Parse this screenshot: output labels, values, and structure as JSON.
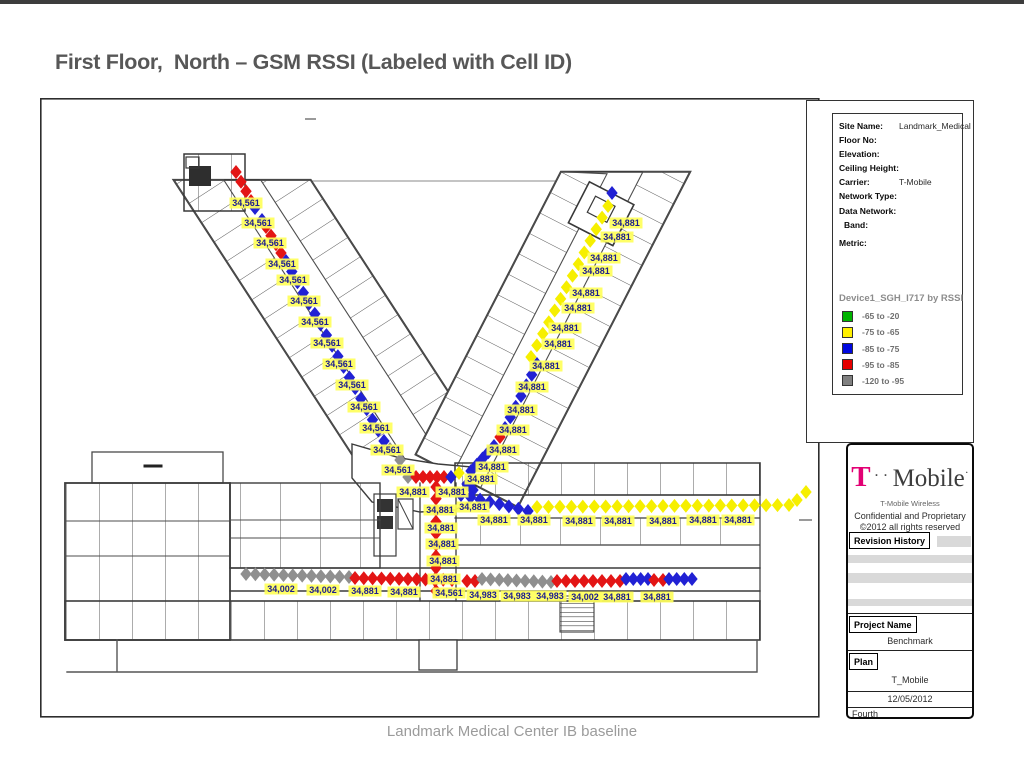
{
  "slide": {
    "title": "First Floor,  North – GSM RSSI (Labeled with Cell ID)",
    "footer": "Landmark Medical Center IB baseline"
  },
  "site_info": {
    "fields": [
      {
        "label": "Site Name:",
        "value": "Landmark_Medical",
        "indent": false,
        "gap": false
      },
      {
        "label": "Floor No:",
        "value": "",
        "indent": false,
        "gap": false
      },
      {
        "label": "Elevation:",
        "value": "",
        "indent": false,
        "gap": false
      },
      {
        "label": "Ceiling Height:",
        "value": "",
        "indent": false,
        "gap": false
      },
      {
        "label": "Carrier:",
        "value": "T-Mobile",
        "indent": false,
        "gap": false
      },
      {
        "label": "Network Type:",
        "value": "",
        "indent": false,
        "gap": false
      },
      {
        "label": "Data Network:",
        "value": "",
        "indent": false,
        "gap": false
      },
      {
        "label": "Band:",
        "value": "",
        "indent": true,
        "gap": false
      },
      {
        "label": "Metric:",
        "value": "",
        "indent": false,
        "gap": true
      }
    ]
  },
  "legend": {
    "title": "Device1_SGH_I717 by RSSI",
    "items": [
      {
        "color": "#00b400",
        "range": "-65 to -20"
      },
      {
        "color": "#fff000",
        "range": "-75 to -65"
      },
      {
        "color": "#0008e0",
        "range": "-85 to -75"
      },
      {
        "color": "#e60000",
        "range": "-95 to -85"
      },
      {
        "color": "#808080",
        "range": "-120 to -95"
      }
    ]
  },
  "titleblock": {
    "logo_t": "T",
    "logo_dots": " · · ",
    "logo_rest": "Mobile",
    "logo_end": "·",
    "company": "T-Mobile Wireless",
    "confidential": "Confidential and Proprietary",
    "copyright": "©2012 all rights reserved",
    "revision_label": "Revision History",
    "project_label": "Project Name",
    "project_value": "Benchmark",
    "plan_label": "Plan",
    "plan_value": "T_Mobile",
    "date": "12/05/2012",
    "floor": "Fourth"
  },
  "plan": {
    "marker_colors": {
      "red": "#e31515",
      "blue": "#2121d4",
      "yellow": "#f6ef00",
      "gray": "#8f8f8f"
    },
    "chains": [
      {
        "c": "red",
        "f": [
          236,
          172
        ],
        "t": [
          251,
          201
        ],
        "n": 4
      },
      {
        "c": "blue",
        "f": [
          255,
          208
        ],
        "t": [
          262,
          220
        ],
        "n": 2
      },
      {
        "c": "red",
        "f": [
          266,
          227
        ],
        "t": [
          281,
          253
        ],
        "n": 4
      },
      {
        "c": "blue",
        "f": [
          286,
          261
        ],
        "t": [
          384,
          441
        ],
        "n": 18
      },
      {
        "c": "gray",
        "f": [
          390,
          449
        ],
        "t": [
          400,
          460
        ],
        "n": 2
      },
      {
        "c": "gray",
        "f": [
          408,
          477
        ],
        "t": [
          408,
          477
        ],
        "n": 1
      },
      {
        "c": "red",
        "f": [
          416,
          477
        ],
        "t": [
          444,
          477
        ],
        "n": 5
      },
      {
        "c": "blue",
        "f": [
          451,
          477
        ],
        "t": [
          451,
          477
        ],
        "n": 1
      },
      {
        "c": "yellow",
        "f": [
          459,
          473
        ],
        "t": [
          459,
          473
        ],
        "n": 1
      },
      {
        "c": "blue",
        "f": [
          612,
          193
        ],
        "t": [
          612,
          193
        ],
        "n": 1
      },
      {
        "c": "yellow",
        "f": [
          608,
          206
        ],
        "t": [
          531,
          357
        ],
        "n": 14
      },
      {
        "c": "blue",
        "f": [
          537,
          364
        ],
        "t": [
          505,
          428
        ],
        "n": 7
      },
      {
        "c": "red",
        "f": [
          500,
          437
        ],
        "t": [
          500,
          437
        ],
        "n": 1
      },
      {
        "c": "blue",
        "f": [
          494,
          446
        ],
        "t": [
          471,
          471
        ],
        "n": 5
      },
      {
        "c": "blue",
        "f": [
          467,
          484
        ],
        "t": [
          473,
          490
        ],
        "n": 2
      },
      {
        "c": "blue",
        "f": [
          461,
          495
        ],
        "t": [
          528,
          511
        ],
        "n": 8
      },
      {
        "c": "yellow",
        "f": [
          537,
          507
        ],
        "t": [
          789,
          505
        ],
        "n": 23
      },
      {
        "c": "yellow",
        "f": [
          797,
          500
        ],
        "t": [
          806,
          492
        ],
        "n": 2
      },
      {
        "c": "red",
        "f": [
          436,
          487
        ],
        "t": [
          436,
          591
        ],
        "n": 10
      },
      {
        "c": "gray",
        "f": [
          246,
          574
        ],
        "t": [
          349,
          577
        ],
        "n": 12
      },
      {
        "c": "red",
        "f": [
          355,
          578
        ],
        "t": [
          452,
          580
        ],
        "n": 12
      },
      {
        "c": "red",
        "f": [
          467,
          581
        ],
        "t": [
          475,
          581
        ],
        "n": 2
      },
      {
        "c": "gray",
        "f": [
          482,
          579
        ],
        "t": [
          551,
          582
        ],
        "n": 9
      },
      {
        "c": "red",
        "f": [
          557,
          581
        ],
        "t": [
          620,
          581
        ],
        "n": 8
      },
      {
        "c": "blue",
        "f": [
          626,
          579
        ],
        "t": [
          648,
          579
        ],
        "n": 4
      },
      {
        "c": "red",
        "f": [
          654,
          580
        ],
        "t": [
          663,
          580
        ],
        "n": 2
      },
      {
        "c": "blue",
        "f": [
          669,
          579
        ],
        "t": [
          692,
          579
        ],
        "n": 4
      }
    ],
    "labels": [
      {
        "t": "34,561",
        "x": 246,
        "y": 203
      },
      {
        "t": "34,561",
        "x": 258,
        "y": 223
      },
      {
        "t": "34,561",
        "x": 270,
        "y": 243
      },
      {
        "t": "34,561",
        "x": 282,
        "y": 264
      },
      {
        "t": "34,561",
        "x": 293,
        "y": 280
      },
      {
        "t": "34,561",
        "x": 304,
        "y": 301
      },
      {
        "t": "34,561",
        "x": 315,
        "y": 322
      },
      {
        "t": "34,561",
        "x": 327,
        "y": 343
      },
      {
        "t": "34,561",
        "x": 339,
        "y": 364
      },
      {
        "t": "34,561",
        "x": 352,
        "y": 385
      },
      {
        "t": "34,561",
        "x": 364,
        "y": 407
      },
      {
        "t": "34,561",
        "x": 376,
        "y": 428
      },
      {
        "t": "34,561",
        "x": 387,
        "y": 450
      },
      {
        "t": "34,561",
        "x": 398,
        "y": 470
      },
      {
        "t": "34,881",
        "x": 626,
        "y": 223
      },
      {
        "t": "34,881",
        "x": 617,
        "y": 237
      },
      {
        "t": "34,881",
        "x": 604,
        "y": 258
      },
      {
        "t": "34,881",
        "x": 596,
        "y": 271
      },
      {
        "t": "34,881",
        "x": 586,
        "y": 293
      },
      {
        "t": "34,881",
        "x": 578,
        "y": 308
      },
      {
        "t": "34,881",
        "x": 565,
        "y": 328
      },
      {
        "t": "34,881",
        "x": 558,
        "y": 344
      },
      {
        "t": "34,881",
        "x": 546,
        "y": 366
      },
      {
        "t": "34,881",
        "x": 532,
        "y": 387
      },
      {
        "t": "34,881",
        "x": 521,
        "y": 410
      },
      {
        "t": "34,881",
        "x": 513,
        "y": 430
      },
      {
        "t": "34,881",
        "x": 503,
        "y": 450
      },
      {
        "t": "34,881",
        "x": 492,
        "y": 467
      },
      {
        "t": "34,881",
        "x": 481,
        "y": 479
      },
      {
        "t": "34,881",
        "x": 413,
        "y": 492
      },
      {
        "t": "34,881",
        "x": 452,
        "y": 492
      },
      {
        "t": "34,881",
        "x": 473,
        "y": 507
      },
      {
        "t": "34,881",
        "x": 440,
        "y": 510
      },
      {
        "t": "34,881",
        "x": 441,
        "y": 528
      },
      {
        "t": "34,881",
        "x": 442,
        "y": 544
      },
      {
        "t": "34,881",
        "x": 443,
        "y": 561
      },
      {
        "t": "34,881",
        "x": 444,
        "y": 579
      },
      {
        "t": "34,561",
        "x": 449,
        "y": 593
      },
      {
        "t": "34,881",
        "x": 494,
        "y": 520
      },
      {
        "t": "34,881",
        "x": 534,
        "y": 520
      },
      {
        "t": "34,881",
        "x": 579,
        "y": 521
      },
      {
        "t": "34,881",
        "x": 618,
        "y": 521
      },
      {
        "t": "34,881",
        "x": 663,
        "y": 521
      },
      {
        "t": "34,881",
        "x": 703,
        "y": 520
      },
      {
        "t": "34,881",
        "x": 738,
        "y": 520
      },
      {
        "t": "34,002",
        "x": 281,
        "y": 589
      },
      {
        "t": "34,002",
        "x": 323,
        "y": 590
      },
      {
        "t": "34,881",
        "x": 365,
        "y": 591
      },
      {
        "t": "34,881",
        "x": 404,
        "y": 592
      },
      {
        "t": "34,983",
        "x": 483,
        "y": 595
      },
      {
        "t": "34,983",
        "x": 517,
        "y": 596
      },
      {
        "t": "34,983",
        "x": 550,
        "y": 596
      },
      {
        "t": "34,002",
        "x": 585,
        "y": 597
      },
      {
        "t": "34,881",
        "x": 617,
        "y": 597
      },
      {
        "t": "34,881",
        "x": 657,
        "y": 597
      }
    ]
  }
}
